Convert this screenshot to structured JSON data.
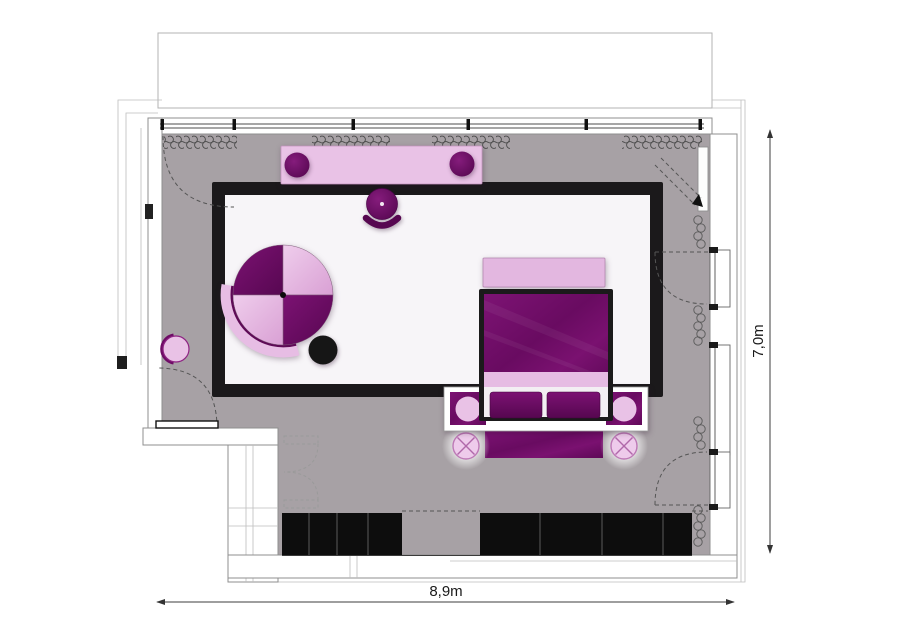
{
  "dimensions": {
    "width_label": "8,9m",
    "height_label": "7,0m"
  },
  "palette": {
    "floor": "#a7a1a5",
    "rug_fill": "#f7f5f8",
    "rug_border": "#1b191b",
    "dark_purple": "#6e0c66",
    "darker_purple": "#560750",
    "light_pink": "#e9c2e6",
    "pale_pink": "#e2b0de",
    "wardrobe_black": "#0d0d0d",
    "line_gray": "#8f8f8f",
    "dim_color": "#3c3c3c",
    "wall_white": "#ffffff"
  },
  "furniture_items": [
    "balcony",
    "window-wall",
    "curtains",
    "console-desk",
    "console-stool-left",
    "console-stool-right",
    "desk-stool",
    "round-lounge-chair",
    "ottoman-side-table",
    "wall-stool",
    "foot-bench",
    "double-bed",
    "pillow-left",
    "pillow-right",
    "headboard-surround",
    "nightstand-left",
    "nightstand-right",
    "ceiling-lamp-left",
    "ceiling-lamp-right",
    "headboard-runner",
    "wardrobe-left",
    "wardrobe-right",
    "entry-door",
    "double-door",
    "window-casement-top",
    "window-fixed",
    "window-casement-bottom",
    "balcony-door-swing"
  ]
}
